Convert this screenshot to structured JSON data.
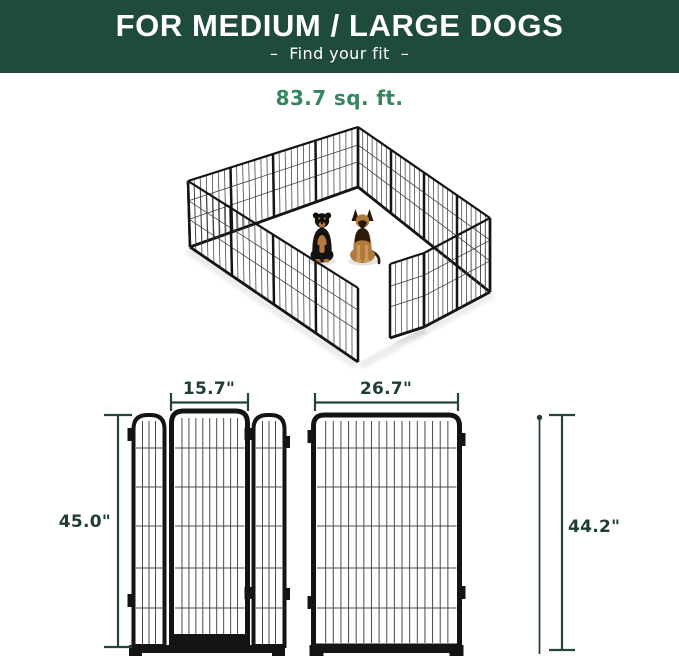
{
  "banner": {
    "title": "FOR MEDIUM / LARGE DOGS",
    "subtitle": "–  Find your fit  –",
    "bg_color": "#1f4b3a",
    "text_color": "#ffffff"
  },
  "area": {
    "label": "83.7 sq. ft.",
    "color": "#35855f"
  },
  "dimensions": {
    "door_width": "15.7\"",
    "door_panel_height": "45.0\"",
    "large_panel_width": "26.7\"",
    "large_panel_height": "44.2\"",
    "line_color": "#25453a",
    "text_color": "#203d33"
  }
}
